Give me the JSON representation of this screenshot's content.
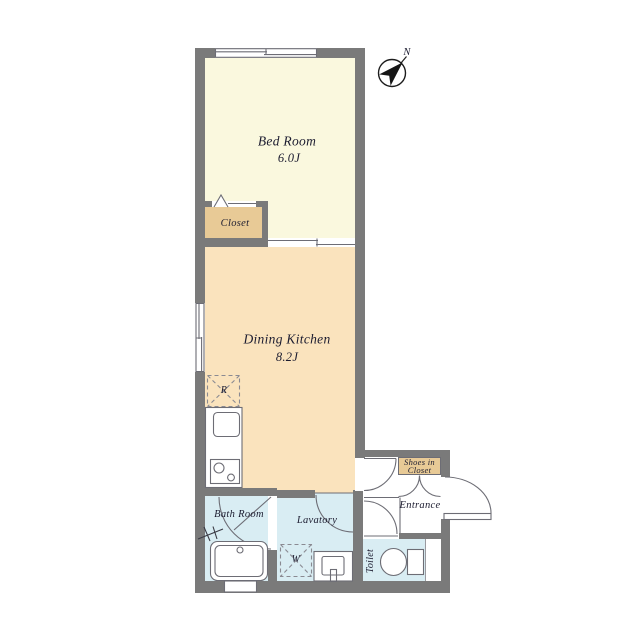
{
  "floor_plan": {
    "rooms": {
      "bedroom": {
        "label": "Bed Room",
        "size": "6.0J",
        "color": "#FAF8DE"
      },
      "dining_kitchen": {
        "label": "Dining Kitchen",
        "size": "8.2J",
        "color": "#FAE3BD"
      },
      "closet": {
        "label": "Closet",
        "color": "#E8CA96"
      },
      "bath_room": {
        "label": "Bath Room",
        "color": "#D9EDF3"
      },
      "lavatory": {
        "label": "Lavatory",
        "color": "#D9EDF3"
      },
      "toilet": {
        "label": "Toilet",
        "color": "#D9EDF3"
      },
      "entrance": {
        "label": "Entrance",
        "color": "#FFFFFF"
      },
      "shoes_in_closet": {
        "label_line1": "Shoes in",
        "label_line2": "Closet",
        "color": "#E8CA96"
      }
    },
    "fixtures": {
      "refrigerator_symbol": "R",
      "washing_machine_symbol": "W"
    },
    "compass": {
      "north_label": "N"
    },
    "wall_color": "#7A7A7A",
    "line_color": "#6D6D75",
    "text_color": "#1C1C30"
  }
}
